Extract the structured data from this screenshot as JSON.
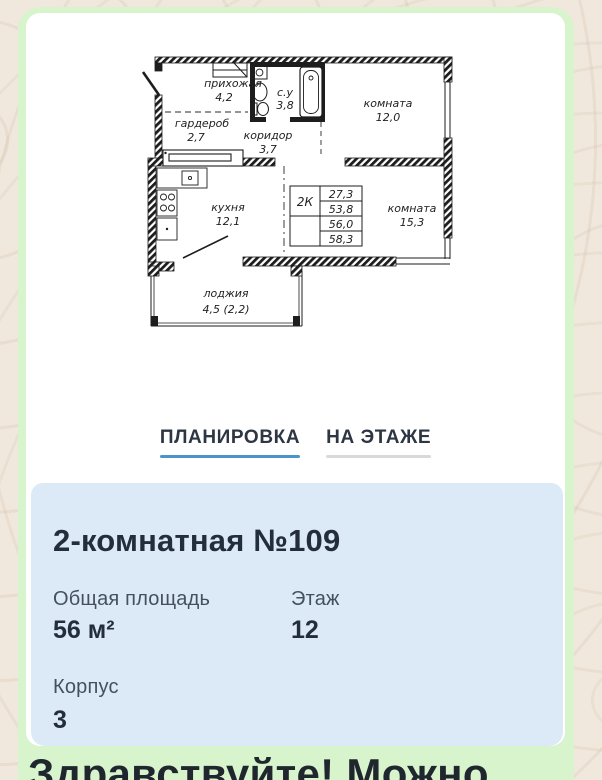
{
  "colors": {
    "page_background": "#f0e8dd",
    "bubble_green": "#d8f4cc",
    "card_white": "#ffffff",
    "info_panel_blue": "#dceaf7",
    "tab_active_underline": "#4b94c9",
    "tab_inactive_underline": "#d9d9d9",
    "text_dark": "#242d3c"
  },
  "tabs": [
    {
      "label": "ПЛАНИРОВКА",
      "active": true
    },
    {
      "label": "НА ЭТАЖЕ",
      "active": false
    }
  ],
  "info": {
    "title": "2-комнатная №109",
    "fields": [
      {
        "label": "Общая площадь",
        "value": "56 м²"
      },
      {
        "label": "Этаж",
        "value": "12"
      },
      {
        "label": "Корпус",
        "value": "3"
      }
    ]
  },
  "floor_plan": {
    "apartment_type": "2К",
    "area_table": [
      "27,3",
      "53,8",
      "56,0",
      "58,3"
    ],
    "rooms": [
      {
        "name": "прихожая",
        "area": "4,2"
      },
      {
        "name": "с.у",
        "area": "3,8"
      },
      {
        "name": "комната",
        "area": "12,0"
      },
      {
        "name": "гардероб",
        "area": "2,7"
      },
      {
        "name": "коридор",
        "area": "3,7"
      },
      {
        "name": "кухня",
        "area": "12,1"
      },
      {
        "name": "комната",
        "area": "15,3"
      },
      {
        "name": "лоджия",
        "area": "4,5 (2,2)"
      }
    ]
  },
  "chat": {
    "message_preview": "Здравствуйте! Можно"
  }
}
